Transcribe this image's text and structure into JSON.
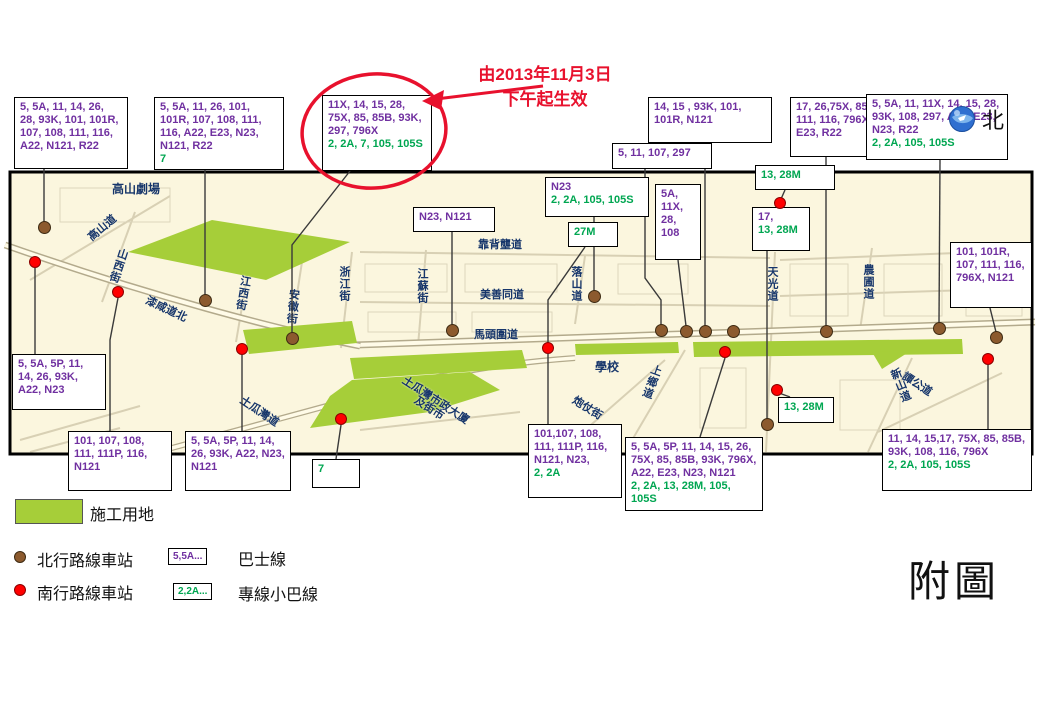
{
  "annotation": {
    "line1": "由2013年11月3日",
    "line2": "下午起生效"
  },
  "north_label": "北",
  "figure_label": "附圖",
  "colors": {
    "bus_route": "#7030A0",
    "minibus_route": "#00A651",
    "highlight_red": "#E8112D",
    "construction": "#A6CE39",
    "northbound_stop": "#8C5A2E",
    "southbound_stop": "#FF0000",
    "street_label": "#17366B",
    "map_background": "#FBF6DE"
  },
  "legend": {
    "construction_label": "施工用地",
    "north_stop_label": "北行路線車站",
    "south_stop_label": "南行路線車站",
    "bus_sample": "5,5A...",
    "bus_label": "巴士線",
    "minibus_sample": "2,2A...",
    "minibus_label": "專線小巴線"
  },
  "callouts": [
    {
      "id": "A",
      "x": 14,
      "y": 97,
      "w": 114,
      "h": 72,
      "bus": "5, 5A, 11, 14, 26, 28, 93K, 101, 101R, 107, 108, 111, 116, A22, N121, R22",
      "mini": ""
    },
    {
      "id": "B",
      "x": 154,
      "y": 97,
      "w": 130,
      "h": 72,
      "bus": "5, 5A, 11, 26, 101, 101R, 107, 108, 111, 116, A22, E23, N23, N121, R22",
      "mini": "7"
    },
    {
      "id": "C",
      "x": 322,
      "y": 95,
      "w": 110,
      "h": 76,
      "bus": "11X, 14, 15, 28, 75X, 85, 85B, 93K, 297, 796X",
      "mini": "2, 2A, 7, 105, 105S",
      "circled": true
    },
    {
      "id": "D",
      "x": 612,
      "y": 143,
      "w": 100,
      "h": 26,
      "bus": "5, 11, 107, 297",
      "mini": ""
    },
    {
      "id": "E",
      "x": 648,
      "y": 97,
      "w": 124,
      "h": 46,
      "bus": "14, 15 , 93K, 101, 101R, N121",
      "mini": ""
    },
    {
      "id": "F",
      "x": 790,
      "y": 97,
      "w": 116,
      "h": 60,
      "bus": "17, 26,75X, 85, 85B, 111, 116, 796X, A22, E23, R22",
      "mini": ""
    },
    {
      "id": "G",
      "x": 755,
      "y": 165,
      "w": 80,
      "h": 25,
      "bus": "",
      "mini": "13, 28M"
    },
    {
      "id": "H",
      "x": 866,
      "y": 94,
      "w": 142,
      "h": 66,
      "bus": "5, 5A, 11, 11X, 14, 15, 28, 93K, 108, 297, A22, E23, N23, R22",
      "mini": "2, 2A, 105, 105S"
    },
    {
      "id": "I",
      "x": 950,
      "y": 242,
      "w": 82,
      "h": 66,
      "bus": "101, 101R, 107, 111, 116, 796X, N121",
      "mini": ""
    },
    {
      "id": "J",
      "x": 545,
      "y": 177,
      "w": 104,
      "h": 40,
      "bus": "N23",
      "mini": "2, 2A, 105, 105S"
    },
    {
      "id": "K",
      "x": 413,
      "y": 207,
      "w": 82,
      "h": 25,
      "bus": "N23, N121",
      "mini": ""
    },
    {
      "id": "L",
      "x": 568,
      "y": 222,
      "w": 50,
      "h": 25,
      "bus": "",
      "mini": "27M"
    },
    {
      "id": "M",
      "x": 655,
      "y": 184,
      "w": 46,
      "h": 76,
      "bus": "5A, 11X, 28, 108",
      "mini": ""
    },
    {
      "id": "N",
      "x": 752,
      "y": 207,
      "w": 58,
      "h": 44,
      "bus": "17,",
      "mini": "13, 28M"
    },
    {
      "id": "O",
      "x": 12,
      "y": 354,
      "w": 94,
      "h": 56,
      "bus": "5, 5A, 5P, 11, 14, 26, 93K, A22, N23",
      "mini": ""
    },
    {
      "id": "P",
      "x": 68,
      "y": 431,
      "w": 104,
      "h": 60,
      "bus": "101, 107, 108, 111, 111P, 116, N121",
      "mini": ""
    },
    {
      "id": "Q",
      "x": 185,
      "y": 431,
      "w": 106,
      "h": 60,
      "bus": "5, 5A, 5P, 11, 14, 26, 93K, A22, N23, N121",
      "mini": ""
    },
    {
      "id": "R",
      "x": 312,
      "y": 459,
      "w": 48,
      "h": 29,
      "bus": "",
      "mini": "7"
    },
    {
      "id": "S",
      "x": 528,
      "y": 424,
      "w": 94,
      "h": 74,
      "bus": "101,107, 108, 111, 111P, 116, N121, N23,",
      "mini": "2, 2A"
    },
    {
      "id": "T",
      "x": 625,
      "y": 437,
      "w": 138,
      "h": 74,
      "bus": "5, 5A, 5P, 11, 14, 15, 26, 75X, 85, 85B, 93K, 796X, A22, E23, N23, N121",
      "mini": "2, 2A, 13, 28M, 105, 105S"
    },
    {
      "id": "U",
      "x": 778,
      "y": 397,
      "w": 56,
      "h": 26,
      "bus": "",
      "mini": "13, 28M"
    },
    {
      "id": "V",
      "x": 882,
      "y": 429,
      "w": 150,
      "h": 62,
      "bus": "11, 14, 15,17, 75X, 85, 85B, 93K, 108, 116, 796X",
      "mini": "2, 2A, 105, 105S"
    }
  ],
  "streets": [
    {
      "label": "高山劇場",
      "x": 112,
      "y": 180,
      "rot": 0,
      "vert": false,
      "place": true
    },
    {
      "label": "高山道",
      "x": 84,
      "y": 232,
      "rot": -40,
      "vert": false
    },
    {
      "label": "山西街",
      "x": 116,
      "y": 246,
      "rot": 18,
      "vert": true
    },
    {
      "label": "漆咸道北",
      "x": 150,
      "y": 292,
      "rot": 25,
      "vert": false
    },
    {
      "label": "江西街",
      "x": 238,
      "y": 274,
      "rot": 10,
      "vert": true
    },
    {
      "label": "安徽街",
      "x": 286,
      "y": 288,
      "rot": 5,
      "vert": true
    },
    {
      "label": "浙江街",
      "x": 336,
      "y": 266,
      "rot": 0,
      "vert": true
    },
    {
      "label": "江蘇街",
      "x": 414,
      "y": 268,
      "rot": 0,
      "vert": true
    },
    {
      "label": "靠背壟道",
      "x": 478,
      "y": 236,
      "rot": 0,
      "vert": false
    },
    {
      "label": "美善同道",
      "x": 480,
      "y": 286,
      "rot": 0,
      "vert": false
    },
    {
      "label": "馬頭圍道",
      "x": 474,
      "y": 326,
      "rot": 0,
      "vert": false
    },
    {
      "label": "落山道",
      "x": 568,
      "y": 266,
      "rot": 0,
      "vert": true
    },
    {
      "label": "學校",
      "x": 595,
      "y": 358,
      "rot": 0,
      "vert": false,
      "place": true
    },
    {
      "label": "炮仗街",
      "x": 578,
      "y": 392,
      "rot": 32,
      "vert": false
    },
    {
      "label": "上鄉道",
      "x": 650,
      "y": 362,
      "rot": 20,
      "vert": true
    },
    {
      "label": "土瓜灣道",
      "x": 246,
      "y": 392,
      "rot": 34,
      "vert": false
    },
    {
      "label": "土瓜灣市政大廈",
      "x": 408,
      "y": 372,
      "rot": 33,
      "vert": false
    },
    {
      "label": "及街市",
      "x": 420,
      "y": 392,
      "rot": 33,
      "vert": false
    },
    {
      "label": "天光道",
      "x": 764,
      "y": 266,
      "rot": 0,
      "vert": true
    },
    {
      "label": "農圃道",
      "x": 860,
      "y": 264,
      "rot": 0,
      "vert": true
    },
    {
      "label": "新山道",
      "x": 886,
      "y": 372,
      "rot": -22,
      "vert": true
    },
    {
      "label": "譚公道",
      "x": 908,
      "y": 368,
      "rot": 33,
      "vert": false
    }
  ],
  "stops": [
    {
      "type": "north",
      "x": 44,
      "y": 227
    },
    {
      "type": "north",
      "x": 205,
      "y": 300
    },
    {
      "type": "north",
      "x": 292,
      "y": 338
    },
    {
      "type": "north",
      "x": 452,
      "y": 330
    },
    {
      "type": "north",
      "x": 594,
      "y": 296
    },
    {
      "type": "north",
      "x": 661,
      "y": 330
    },
    {
      "type": "north",
      "x": 686,
      "y": 331
    },
    {
      "type": "north",
      "x": 705,
      "y": 331
    },
    {
      "type": "north",
      "x": 733,
      "y": 331
    },
    {
      "type": "north",
      "x": 826,
      "y": 331
    },
    {
      "type": "north",
      "x": 939,
      "y": 328
    },
    {
      "type": "north",
      "x": 996,
      "y": 337
    },
    {
      "type": "north",
      "x": 767,
      "y": 424
    },
    {
      "type": "south",
      "x": 35,
      "y": 262
    },
    {
      "type": "south",
      "x": 118,
      "y": 292
    },
    {
      "type": "south",
      "x": 242,
      "y": 349
    },
    {
      "type": "south",
      "x": 341,
      "y": 419
    },
    {
      "type": "south",
      "x": 548,
      "y": 348
    },
    {
      "type": "south",
      "x": 725,
      "y": 352
    },
    {
      "type": "south",
      "x": 777,
      "y": 390
    },
    {
      "type": "south",
      "x": 780,
      "y": 203
    },
    {
      "type": "south",
      "x": 988,
      "y": 359
    }
  ],
  "connectors": [
    {
      "points": "44,168 44,222"
    },
    {
      "points": "205,168 205,295"
    },
    {
      "points": "350,171 292,245 292,333"
    },
    {
      "points": "645,169 645,278 661,300 661,325"
    },
    {
      "points": "705,143 705,326"
    },
    {
      "points": "826,157 826,326"
    },
    {
      "points": "785,190 781,199"
    },
    {
      "points": "940,160 939,323"
    },
    {
      "points": "990,308 996,332"
    },
    {
      "points": "594,217 594,291"
    },
    {
      "points": "452,232 452,325"
    },
    {
      "points": "585,247 548,300 548,343"
    },
    {
      "points": "678,260 686,326"
    },
    {
      "points": "767,251 767,419"
    },
    {
      "points": "35,354 35,268"
    },
    {
      "points": "110,431 110,340 118,298"
    },
    {
      "points": "242,431 242,355"
    },
    {
      "points": "336,459 341,425"
    },
    {
      "points": "548,424 548,354"
    },
    {
      "points": "700,437 725,358"
    },
    {
      "points": "790,397 779,393"
    },
    {
      "points": "988,429 988,365"
    }
  ],
  "construction_zones": [
    "128,252 212,220 350,242 266,280",
    "243,330 352,321 357,343 249,354",
    "350,358 522,350 527,368 354,379",
    "352,380 470,372 500,390 430,412 310,428 330,396",
    "575,344 678,342 679,353 576,355",
    "693,342 962,339 963,354 694,357",
    "872,352 912,350 882,369"
  ]
}
